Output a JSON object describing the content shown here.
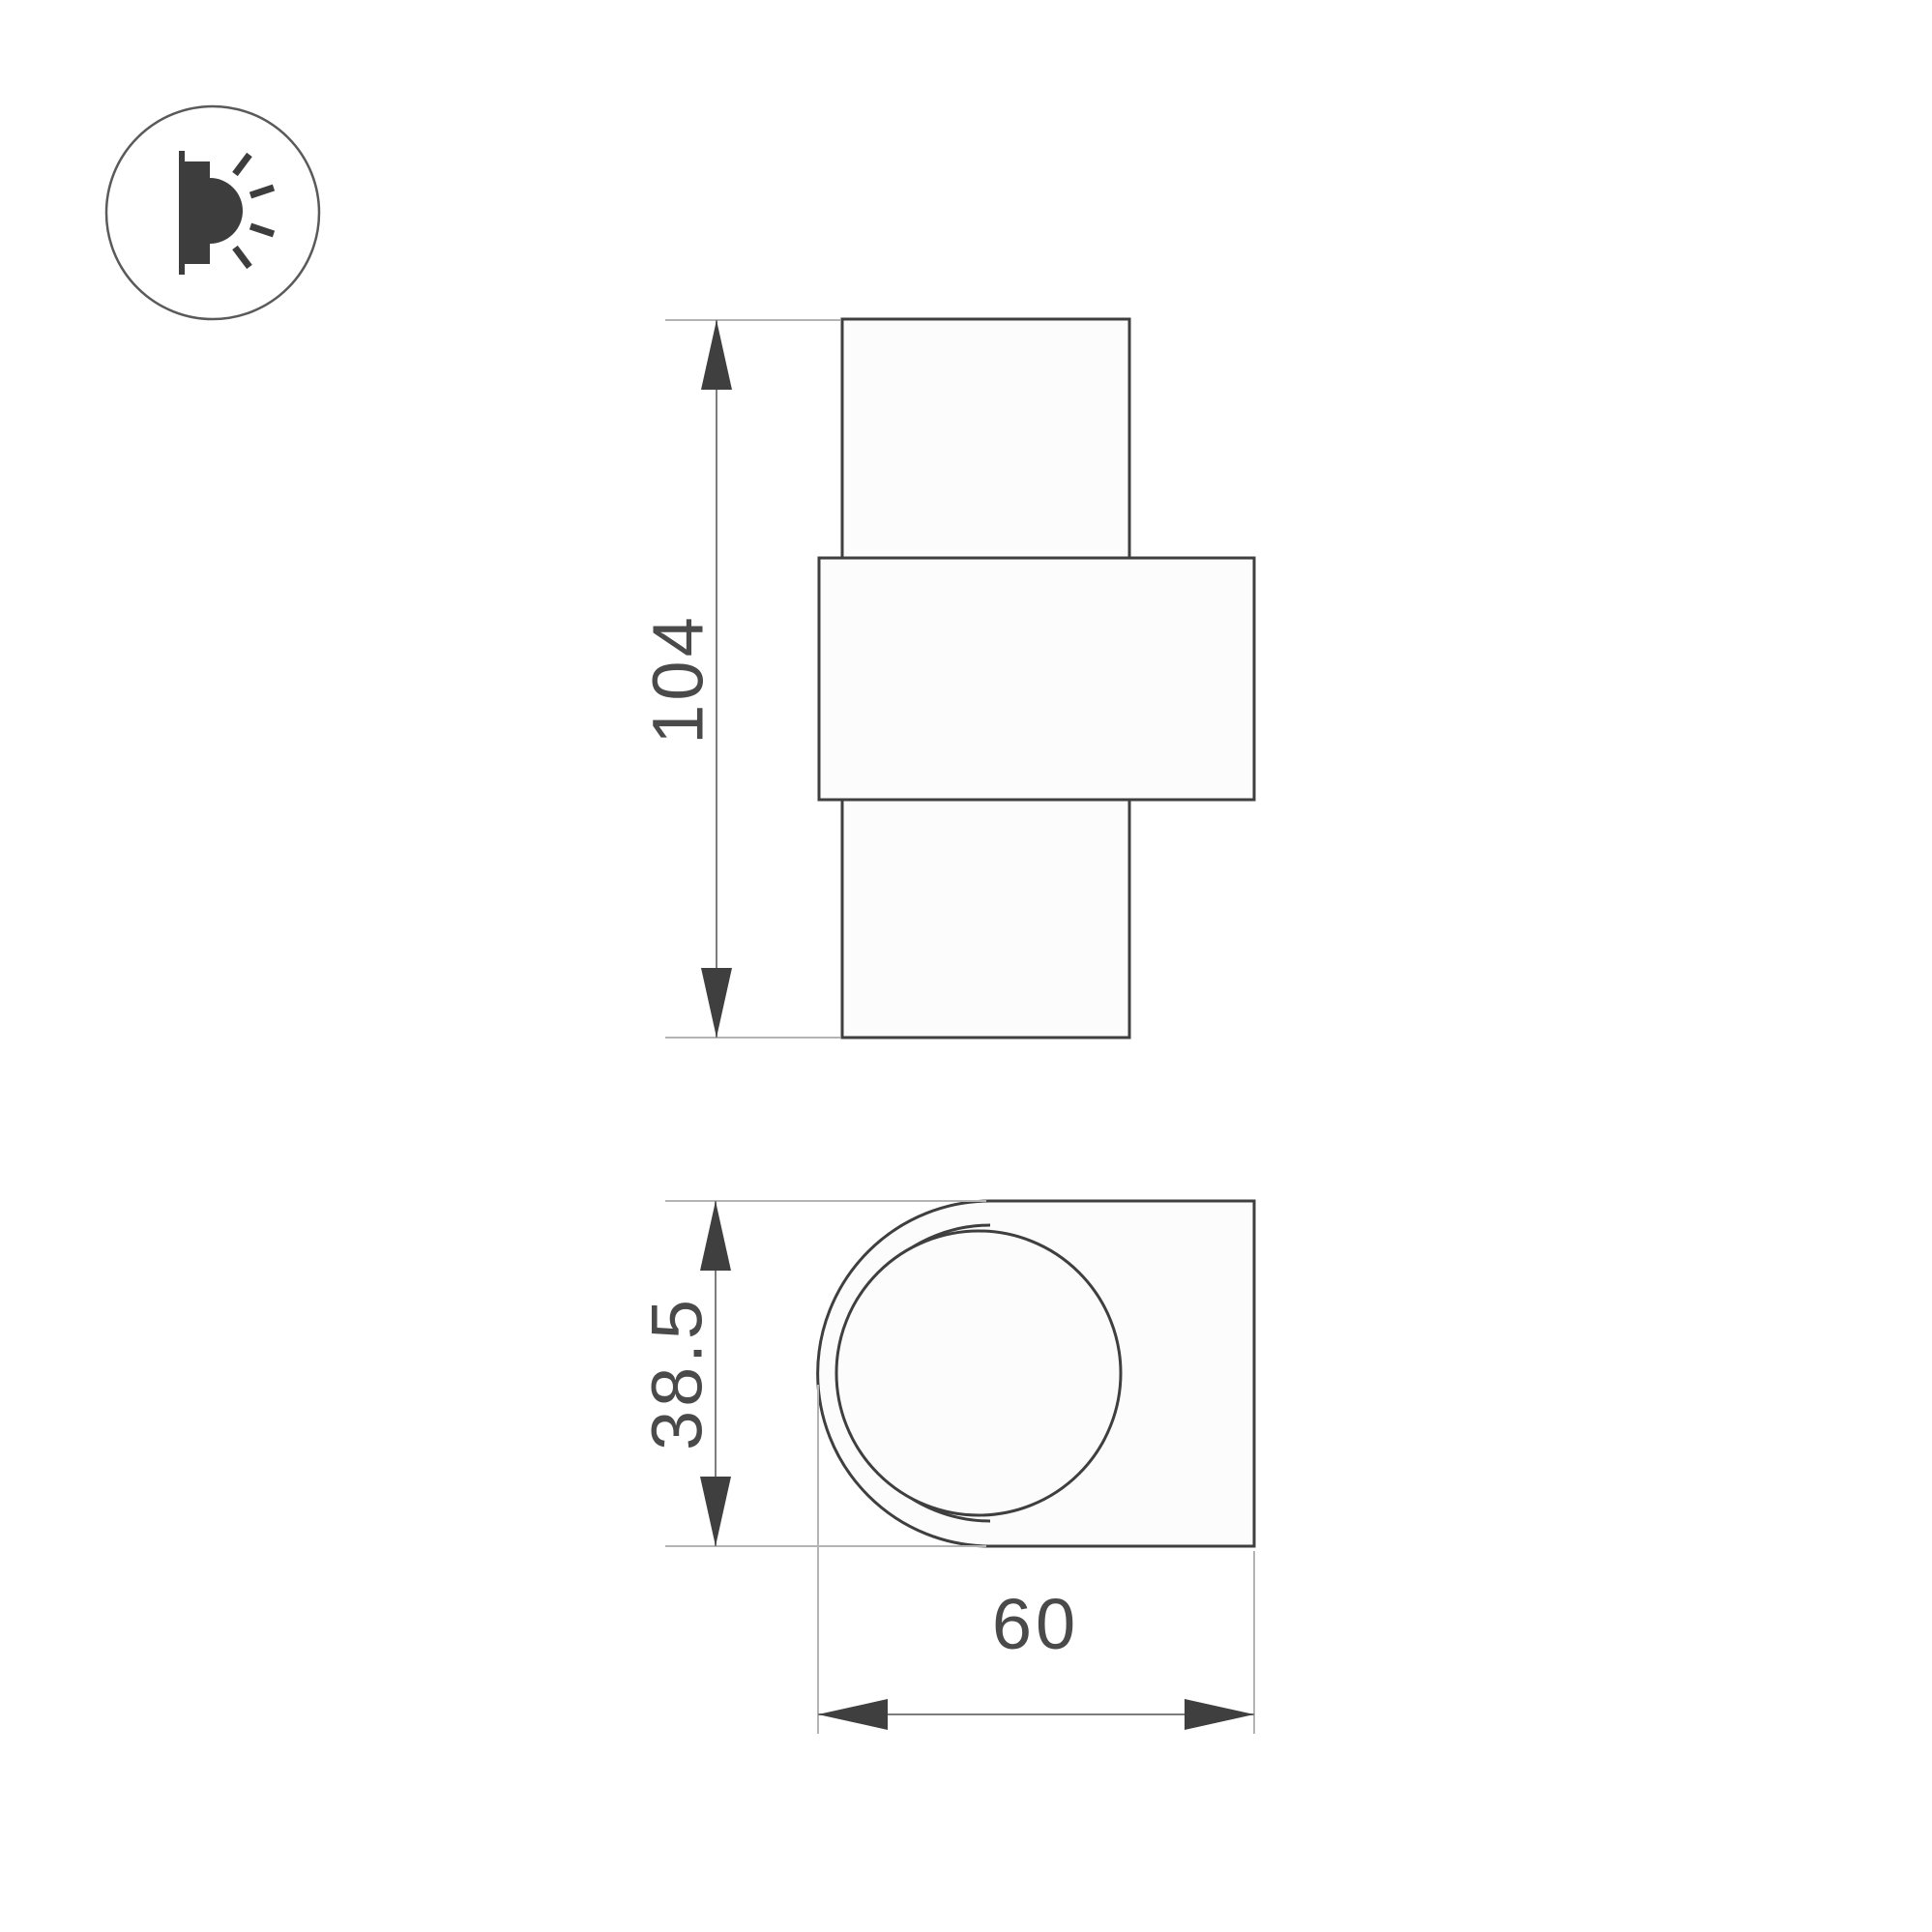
{
  "icon": {
    "name": "wall-lamp-side-light-icon"
  },
  "front_view": {
    "height_dimension": "104"
  },
  "top_view": {
    "depth_dimension": "38.5",
    "width_dimension": "60"
  },
  "colors": {
    "outline": "#3f3f3f",
    "extension_line": "#b4b4b4",
    "dimension_line": "#7d7d7d",
    "text": "#4a4a4a",
    "background": "#ffffff"
  }
}
